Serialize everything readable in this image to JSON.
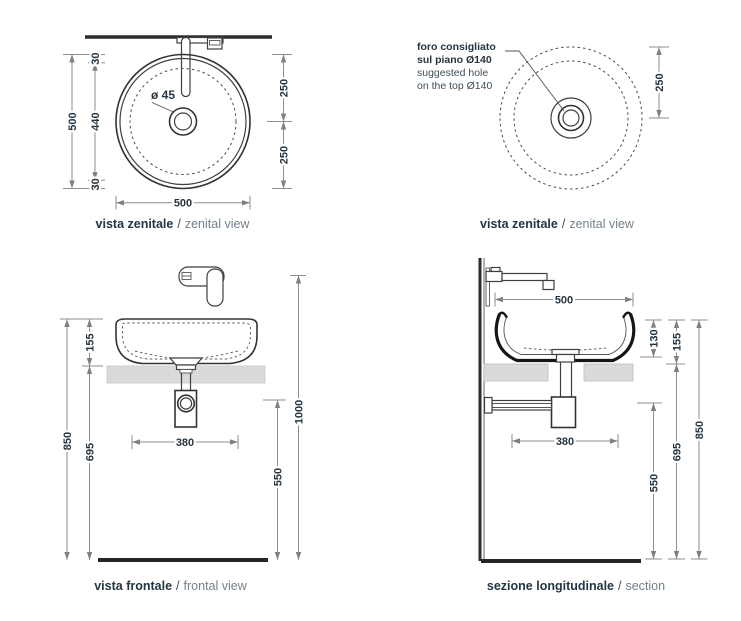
{
  "colors": {
    "line": "#3f3f3f",
    "section_line": "#161616",
    "dim_line": "#8e8e8e",
    "text": "#263540",
    "text_light": "#75828b",
    "counter": "#dadada",
    "floor": "#262626",
    "background": "#ffffff"
  },
  "views": {
    "zenital_left": {
      "caption": {
        "bold": "vista zenitale",
        "sep": "/",
        "light": "zenital view"
      },
      "drain_label": "ø 45",
      "dim_total_height": "500",
      "dim_offset_top": "30",
      "dim_inner_height": "440",
      "dim_offset_bottom": "30",
      "dim_right_upper": "250",
      "dim_right_lower": "250",
      "dim_width": "500"
    },
    "zenital_right": {
      "caption": {
        "bold": "vista zenitale",
        "sep": "/",
        "light": "zenital view"
      },
      "note": {
        "line1_bold": "foro consigliato",
        "line2_bold": "sul piano Ø140",
        "line3": "suggested hole",
        "line4": "on the top Ø140"
      },
      "dim_center_offset": "250"
    },
    "frontal": {
      "caption": {
        "bold": "vista frontale",
        "sep": "/",
        "light": "frontal view"
      },
      "dim_basin_height": "155",
      "dim_wall_height": "850",
      "dim_under_counter": "695",
      "dim_drain_spacing": "380",
      "dim_faucet_height": "1000",
      "dim_drain_height": "550"
    },
    "section": {
      "caption": {
        "bold": "sezione longitudinale",
        "sep": "/",
        "light": "section"
      },
      "dim_width": "500",
      "dim_inner_depth": "130",
      "dim_basin_height": "155",
      "dim_wall_height": "850",
      "dim_under_counter": "695",
      "dim_drain_spacing": "380",
      "dim_drain_height": "550"
    }
  }
}
